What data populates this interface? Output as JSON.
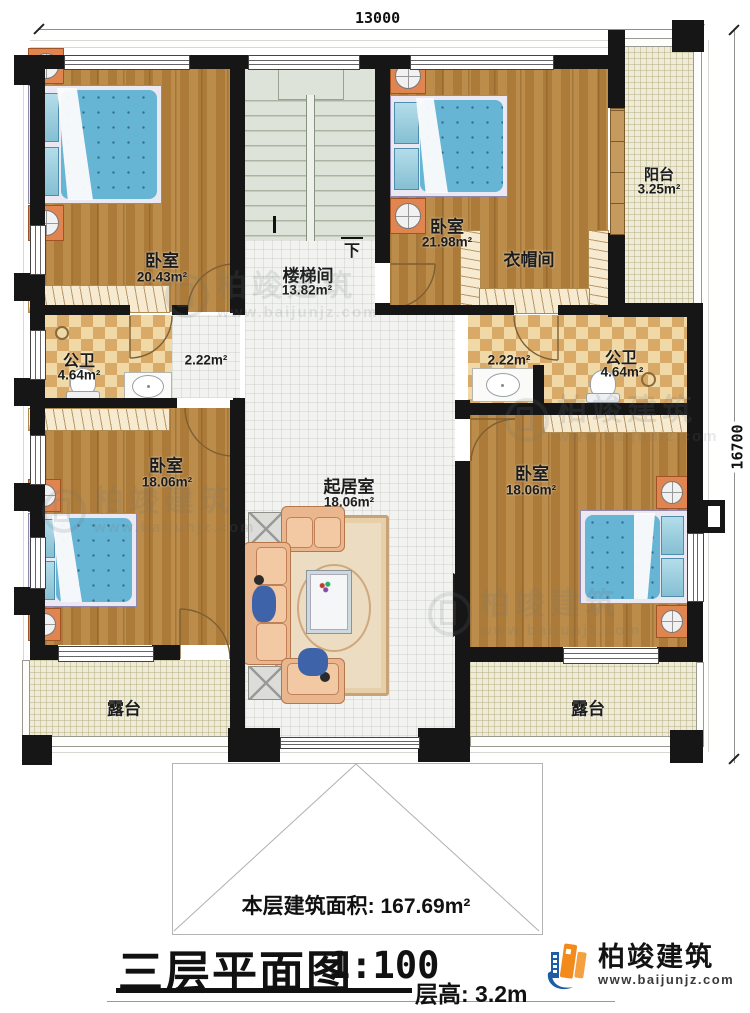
{
  "dimensions": {
    "width_mm": "13000",
    "height_mm": "16700"
  },
  "rooms": {
    "bedroom_tl": {
      "name": "卧室",
      "area": "20.43m²"
    },
    "stairwell": {
      "name": "楼梯间",
      "area": "13.82m²",
      "down_label": "下"
    },
    "bedroom_tr": {
      "name": "卧室",
      "area": "21.98m²"
    },
    "cloakroom": {
      "name": "衣帽间"
    },
    "balcony": {
      "name": "阳台",
      "area": "3.25m²"
    },
    "bath_left": {
      "name": "公卫",
      "area": "4.64m²"
    },
    "hall_left": {
      "area": "2.22m²"
    },
    "hall_right": {
      "area": "2.22m²"
    },
    "bath_right": {
      "name": "公卫",
      "area": "4.64m²"
    },
    "bedroom_bl": {
      "name": "卧室",
      "area": "18.06m²"
    },
    "living": {
      "name": "起居室",
      "area": "18.06m²"
    },
    "bedroom_br": {
      "name": "卧室",
      "area": "18.06m²"
    },
    "terrace_left": {
      "name": "露台"
    },
    "terrace_right": {
      "name": "露台"
    }
  },
  "annotations": {
    "floor_area": "本层建筑面积: 167.69m²",
    "title": "三层平面图",
    "scale": "1:100",
    "floor_height": "层高: 3.2m"
  },
  "branding": {
    "company": "柏竣建筑",
    "website": "www.baijunjz.com"
  },
  "watermark": {
    "company": "柏竣建筑",
    "website": "www.baijunjz.com"
  },
  "colors": {
    "wall": "#161616",
    "wood_floor": "#b17f3c",
    "bed_blue": "#67b5d4",
    "checker_tan": "#d8a967",
    "logo_blue": "#1d5da6",
    "logo_orange": "#f28a1c"
  }
}
